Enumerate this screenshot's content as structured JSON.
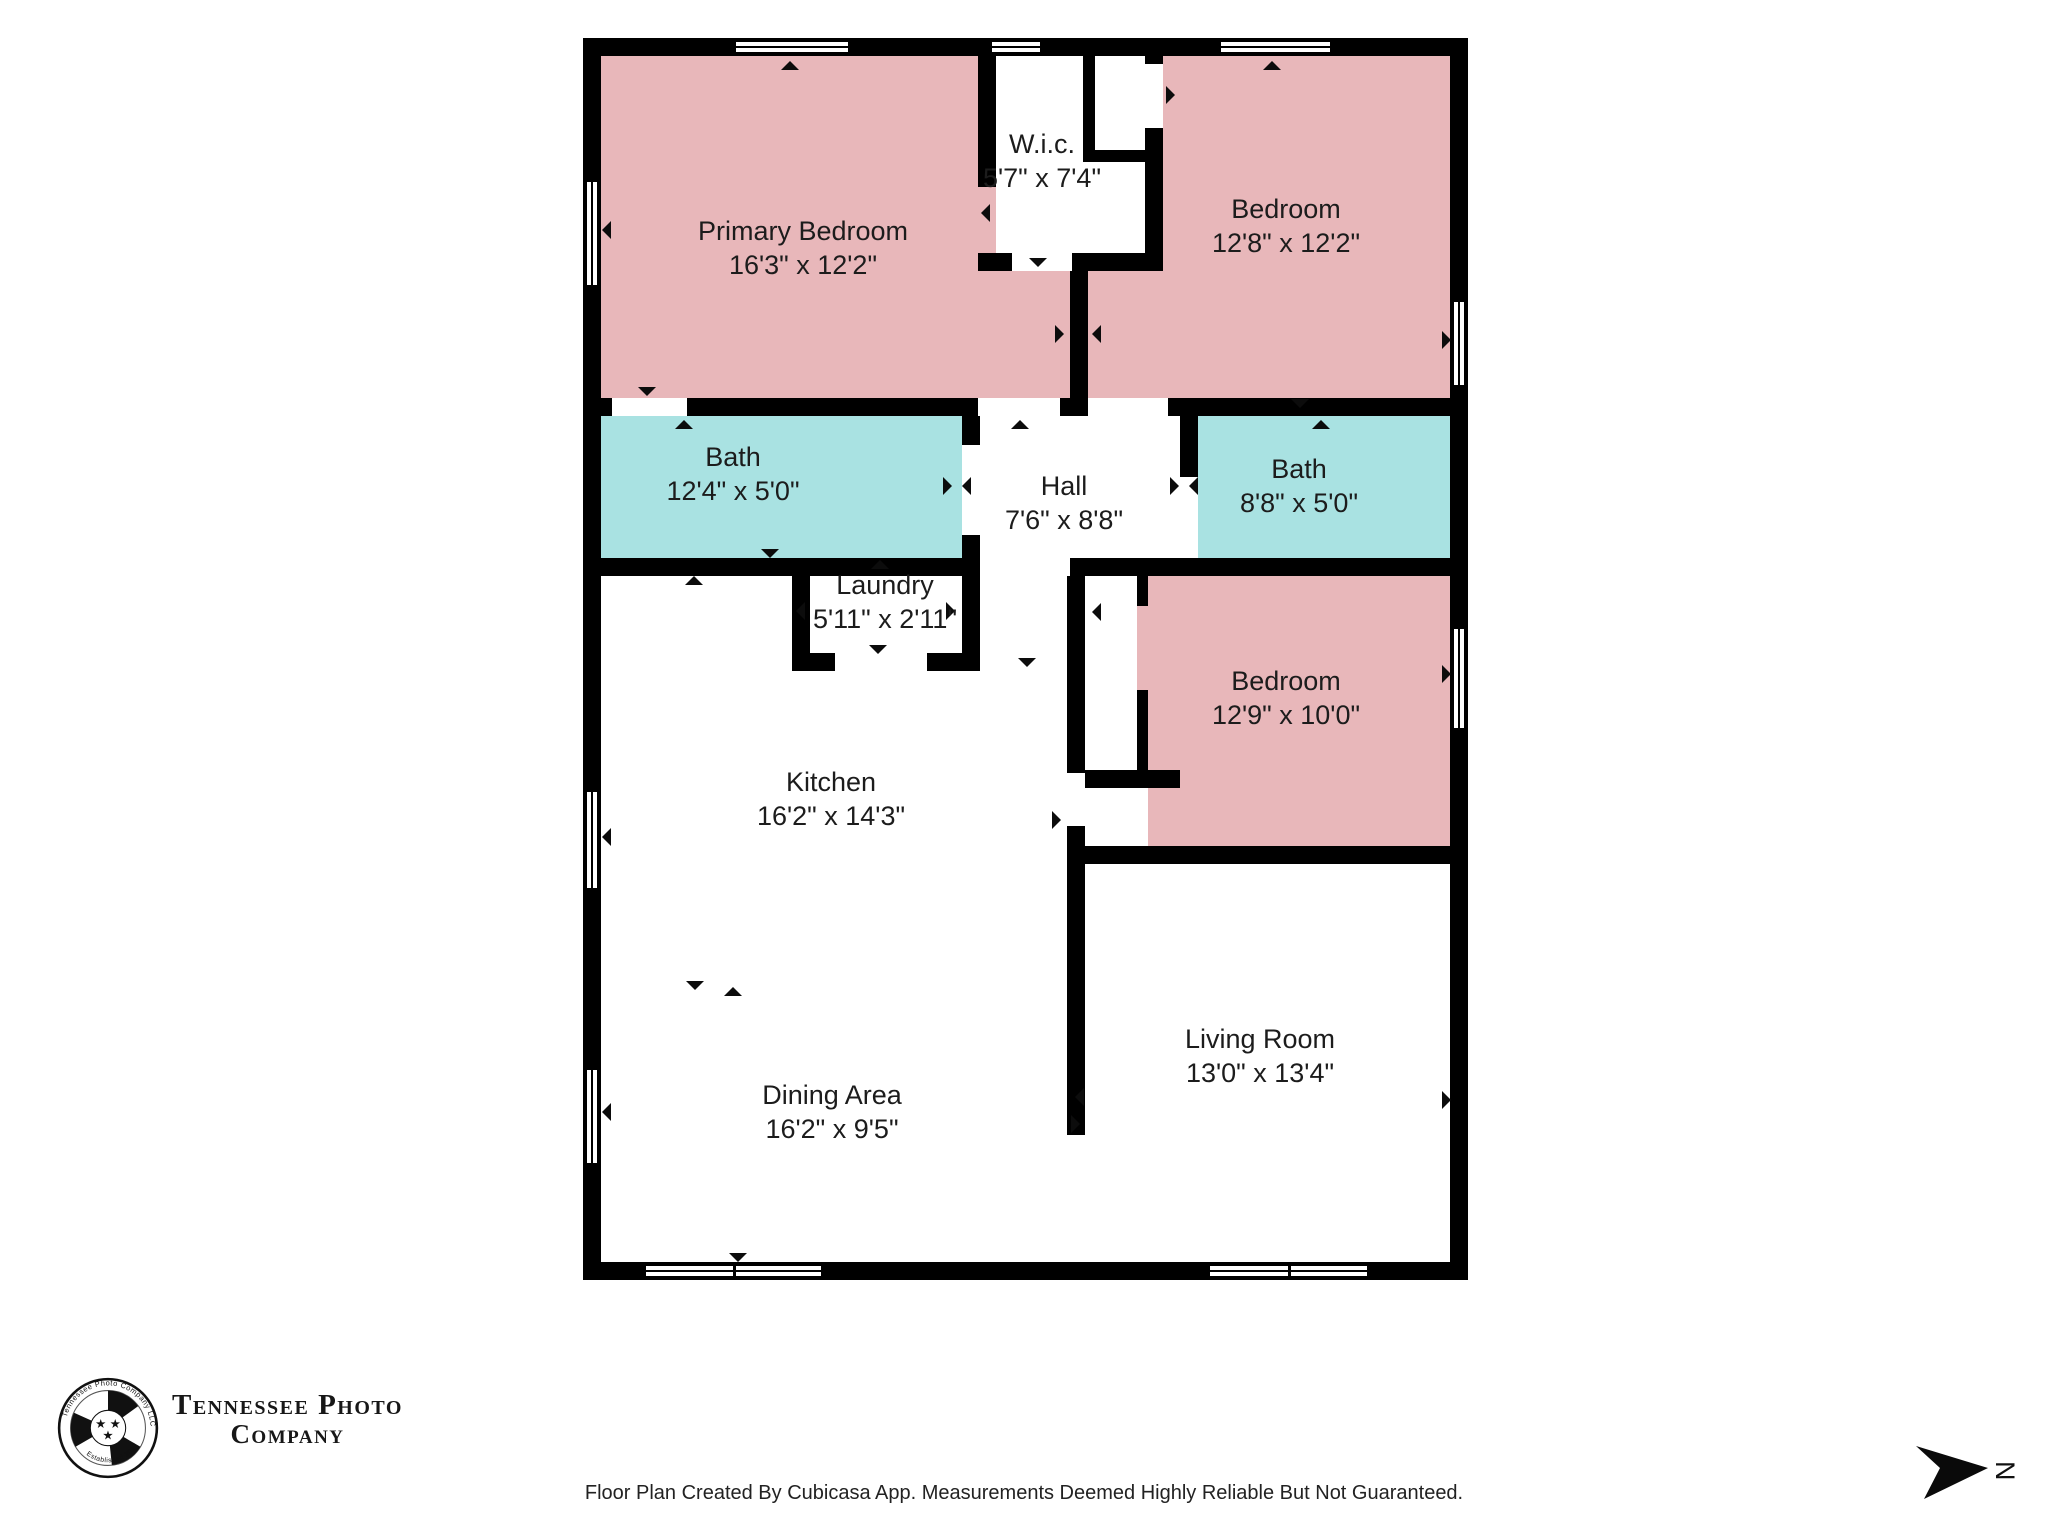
{
  "palette": {
    "wall": "#000000",
    "bedroom_fill": "#e8b7ba",
    "bath_fill": "#a9e2e2",
    "text": "#1c1c1c"
  },
  "rooms": [
    {
      "id": "primary-bedroom",
      "name": "Primary Bedroom",
      "dims": "16'3\" x 12'2\"",
      "fill": "bedroom_fill",
      "rect": [
        601,
        56,
        469,
        342
      ],
      "label": [
        803,
        248
      ]
    },
    {
      "id": "primary-bedroom-vestibule",
      "name": "",
      "dims": "",
      "fill": "bedroom_fill",
      "rect": [
        978,
        271,
        92,
        127
      ],
      "label": null
    },
    {
      "id": "wic",
      "name": "W.i.c.",
      "dims": "5'7\" x 7'4\"",
      "fill": "white",
      "rect": [
        996,
        56,
        167,
        215
      ],
      "label": [
        1042,
        161
      ]
    },
    {
      "id": "bedroom-2",
      "name": "Bedroom",
      "dims": "12'8\" x 12'2\"",
      "fill": "bedroom_fill",
      "rect": [
        1088,
        56,
        362,
        342
      ],
      "label": [
        1286,
        226
      ]
    },
    {
      "id": "bath-1",
      "name": "Bath",
      "dims": "12'4\" x 5'0\"",
      "fill": "bath_fill",
      "rect": [
        601,
        416,
        361,
        142
      ],
      "label": [
        733,
        474
      ]
    },
    {
      "id": "hall",
      "name": "Hall",
      "dims": "7'6\" x 8'8\"",
      "fill": "white",
      "rect": [
        980,
        416,
        200,
        142
      ],
      "label": [
        1064,
        503
      ]
    },
    {
      "id": "bath-2",
      "name": "Bath",
      "dims": "8'8\" x 5'0\"",
      "fill": "bath_fill",
      "rect": [
        1198,
        416,
        252,
        142
      ],
      "label": [
        1299,
        486
      ]
    },
    {
      "id": "laundry",
      "name": "Laundry",
      "dims": "5'11\" x 2'11\"",
      "fill": "bath_fill",
      "rect": [
        810,
        576,
        152,
        77
      ],
      "label": [
        885,
        602
      ]
    },
    {
      "id": "bedroom-3",
      "name": "Bedroom",
      "dims": "12'9\" x 10'0\"",
      "fill": "bedroom_fill",
      "rect": [
        1085,
        576,
        365,
        270
      ],
      "label": [
        1286,
        698
      ]
    },
    {
      "id": "kitchen",
      "name": "Kitchen",
      "dims": "16'2\" x 14'3\"",
      "fill": "white",
      "rect": [
        601,
        576,
        466,
        300
      ],
      "label": [
        831,
        799
      ]
    },
    {
      "id": "dining-area",
      "name": "Dining Area",
      "dims": "16'2\" x 9'5\"",
      "fill": "white",
      "rect": [
        601,
        876,
        466,
        386
      ],
      "label": [
        832,
        1112
      ]
    },
    {
      "id": "living-room",
      "name": "Living Room",
      "dims": "13'0\" x 13'4\"",
      "fill": "white",
      "rect": [
        1085,
        864,
        365,
        398
      ],
      "label": [
        1260,
        1056
      ]
    }
  ],
  "closet_cutouts": [
    {
      "rect": [
        996,
        56,
        167,
        215
      ]
    },
    {
      "rect": [
        1085,
        576,
        52,
        194
      ]
    },
    {
      "rect": [
        1085,
        788,
        63,
        58
      ]
    }
  ],
  "walls": [
    {
      "rect": [
        583,
        38,
        885,
        18
      ]
    },
    {
      "rect": [
        583,
        1262,
        885,
        18
      ]
    },
    {
      "rect": [
        583,
        38,
        18,
        1242
      ]
    },
    {
      "rect": [
        1450,
        38,
        18,
        1242
      ]
    },
    {
      "rect": [
        601,
        398,
        11,
        18
      ]
    },
    {
      "rect": [
        687,
        398,
        291,
        18
      ]
    },
    {
      "rect": [
        1060,
        398,
        28,
        18
      ]
    },
    {
      "rect": [
        1168,
        398,
        282,
        18
      ]
    },
    {
      "rect": [
        978,
        56,
        18,
        131
      ]
    },
    {
      "rect": [
        978,
        253,
        34,
        18
      ]
    },
    {
      "rect": [
        1072,
        253,
        91,
        18
      ]
    },
    {
      "rect": [
        1083,
        56,
        12,
        94
      ]
    },
    {
      "rect": [
        1083,
        150,
        80,
        12
      ]
    },
    {
      "rect": [
        1145,
        56,
        18,
        8
      ]
    },
    {
      "rect": [
        1145,
        128,
        18,
        143
      ]
    },
    {
      "rect": [
        1070,
        271,
        18,
        127
      ]
    },
    {
      "rect": [
        601,
        558,
        379,
        18
      ]
    },
    {
      "rect": [
        962,
        416,
        18,
        29
      ]
    },
    {
      "rect": [
        962,
        535,
        18,
        23
      ]
    },
    {
      "rect": [
        792,
        576,
        18,
        95
      ]
    },
    {
      "rect": [
        962,
        576,
        18,
        95
      ]
    },
    {
      "rect": [
        792,
        653,
        43,
        18
      ]
    },
    {
      "rect": [
        927,
        653,
        53,
        18
      ]
    },
    {
      "rect": [
        1180,
        416,
        18,
        61
      ]
    },
    {
      "rect": [
        1070,
        558,
        380,
        18
      ]
    },
    {
      "rect": [
        1067,
        576,
        18,
        197
      ]
    },
    {
      "rect": [
        1067,
        826,
        18,
        309
      ]
    },
    {
      "rect": [
        1137,
        576,
        11,
        30
      ]
    },
    {
      "rect": [
        1137,
        690,
        11,
        80
      ]
    },
    {
      "rect": [
        1085,
        770,
        95,
        18
      ]
    },
    {
      "rect": [
        1067,
        846,
        383,
        18
      ]
    }
  ],
  "windows": [
    {
      "rect": [
        734,
        40,
        116,
        14
      ],
      "dir": "h",
      "double": false
    },
    {
      "rect": [
        990,
        40,
        52,
        14
      ],
      "dir": "h",
      "double": false
    },
    {
      "rect": [
        1219,
        40,
        113,
        14
      ],
      "dir": "h",
      "double": false
    },
    {
      "rect": [
        585,
        180,
        14,
        107
      ],
      "dir": "v",
      "double": false
    },
    {
      "rect": [
        585,
        790,
        14,
        100
      ],
      "dir": "v",
      "double": false
    },
    {
      "rect": [
        585,
        1068,
        14,
        97
      ],
      "dir": "v",
      "double": false
    },
    {
      "rect": [
        1452,
        300,
        14,
        87
      ],
      "dir": "v",
      "double": false
    },
    {
      "rect": [
        1452,
        627,
        14,
        103
      ],
      "dir": "v",
      "double": false
    },
    {
      "rect": [
        644,
        1264,
        179,
        14
      ],
      "dir": "h",
      "double": true
    },
    {
      "rect": [
        1208,
        1264,
        161,
        14
      ],
      "dir": "h",
      "double": true
    }
  ],
  "arrows": [
    {
      "x": 790,
      "y": 65,
      "dir": "up"
    },
    {
      "x": 1272,
      "y": 65,
      "dir": "up"
    },
    {
      "x": 606,
      "y": 230,
      "dir": "left"
    },
    {
      "x": 606,
      "y": 837,
      "dir": "left"
    },
    {
      "x": 606,
      "y": 1112,
      "dir": "left"
    },
    {
      "x": 1446,
      "y": 340,
      "dir": "right"
    },
    {
      "x": 1446,
      "y": 674,
      "dir": "right"
    },
    {
      "x": 1446,
      "y": 1100,
      "dir": "right"
    },
    {
      "x": 647,
      "y": 391,
      "dir": "down"
    },
    {
      "x": 684,
      "y": 424,
      "dir": "up"
    },
    {
      "x": 1020,
      "y": 424,
      "dir": "up"
    },
    {
      "x": 1300,
      "y": 403,
      "dir": "down"
    },
    {
      "x": 1321,
      "y": 424,
      "dir": "up"
    },
    {
      "x": 1059,
      "y": 334,
      "dir": "right"
    },
    {
      "x": 1096,
      "y": 334,
      "dir": "left"
    },
    {
      "x": 1038,
      "y": 262,
      "dir": "down"
    },
    {
      "x": 985,
      "y": 213,
      "dir": "left"
    },
    {
      "x": 1170,
      "y": 95,
      "dir": "right"
    },
    {
      "x": 770,
      "y": 553,
      "dir": "down"
    },
    {
      "x": 694,
      "y": 580,
      "dir": "up"
    },
    {
      "x": 880,
      "y": 564,
      "dir": "up"
    },
    {
      "x": 878,
      "y": 649,
      "dir": "down"
    },
    {
      "x": 800,
      "y": 611,
      "dir": "left"
    },
    {
      "x": 950,
      "y": 611,
      "dir": "right"
    },
    {
      "x": 947,
      "y": 486,
      "dir": "right"
    },
    {
      "x": 966,
      "y": 486,
      "dir": "left"
    },
    {
      "x": 1174,
      "y": 486,
      "dir": "right"
    },
    {
      "x": 1193,
      "y": 486,
      "dir": "left"
    },
    {
      "x": 1027,
      "y": 662,
      "dir": "down"
    },
    {
      "x": 1056,
      "y": 820,
      "dir": "right"
    },
    {
      "x": 1096,
      "y": 612,
      "dir": "left"
    },
    {
      "x": 695,
      "y": 985,
      "dir": "down"
    },
    {
      "x": 733,
      "y": 991,
      "dir": "up"
    },
    {
      "x": 1079,
      "y": 1097,
      "dir": "left"
    },
    {
      "x": 1075,
      "y": 1124,
      "dir": "right"
    },
    {
      "x": 738,
      "y": 1257,
      "dir": "down"
    }
  ],
  "logo": {
    "line1": "Tennessee Photo",
    "line2": "Company",
    "arc_top": "Tennessee Photo Company LLC",
    "arc_bottom": "Established 2017",
    "stars": "★"
  },
  "footer": {
    "text": "Floor Plan Created By Cubicasa App. Measurements Deemed Highly Reliable But Not Guaranteed."
  },
  "north": {
    "label": "N"
  }
}
